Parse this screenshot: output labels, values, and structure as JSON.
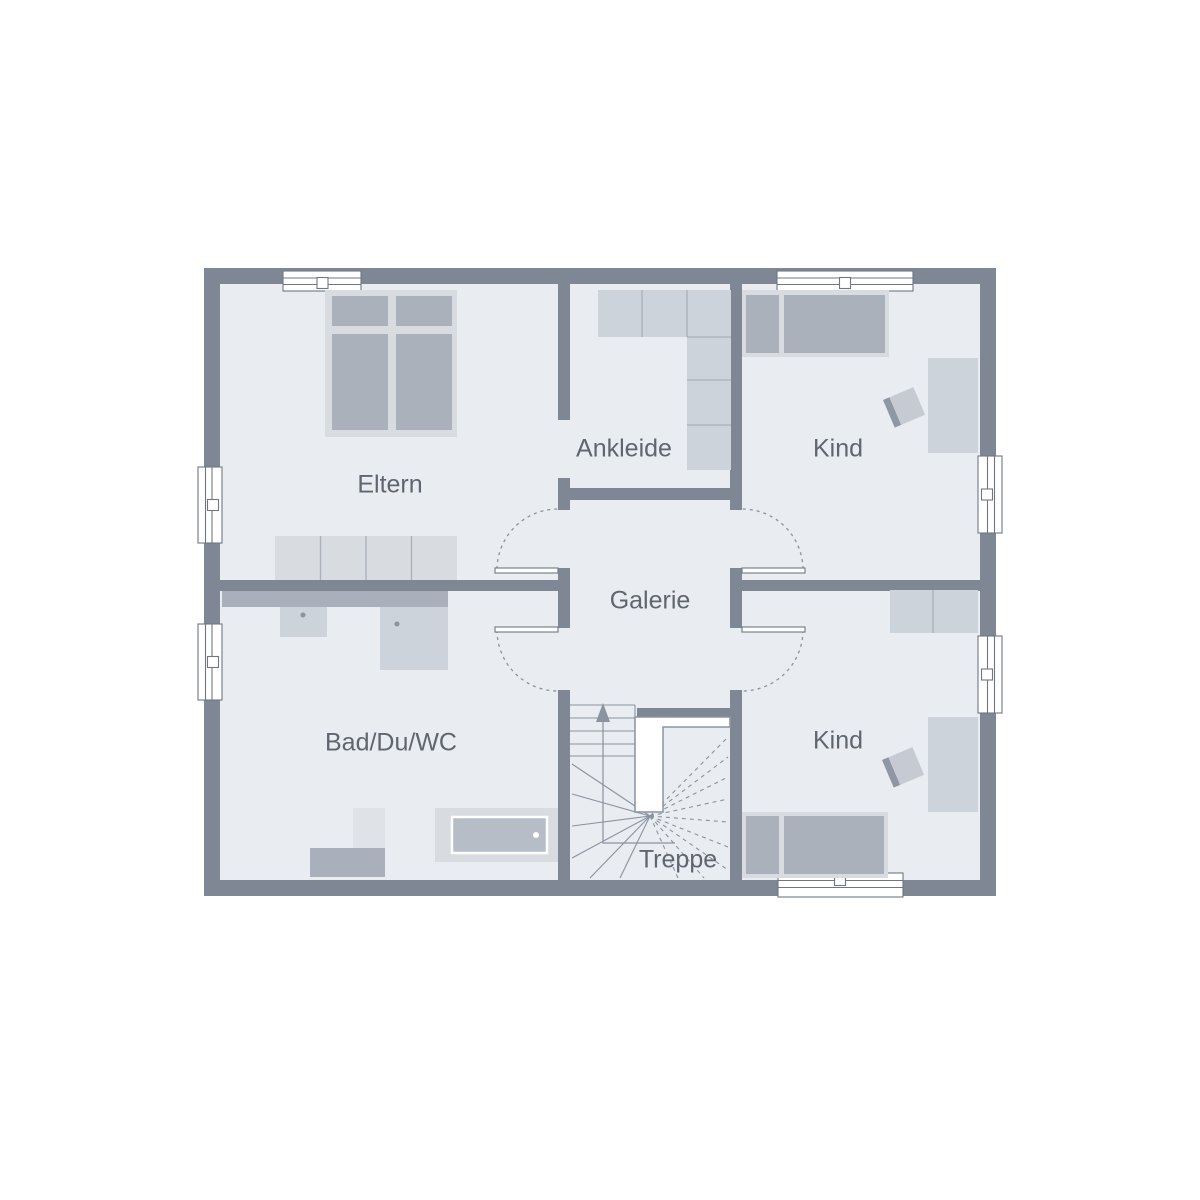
{
  "plan": {
    "type": "floor-plan",
    "rooms": [
      {
        "id": "eltern",
        "label": "Eltern"
      },
      {
        "id": "ankleide",
        "label": "Ankleide"
      },
      {
        "id": "kind-top",
        "label": "Kind"
      },
      {
        "id": "galerie",
        "label": "Galerie"
      },
      {
        "id": "bad",
        "label": "Bad/Du/WC"
      },
      {
        "id": "kind-bottom",
        "label": "Kind"
      },
      {
        "id": "treppe",
        "label": "Treppe"
      }
    ]
  },
  "colors": {
    "wall": "#7E8793",
    "floor": "#E9ECF0",
    "furn-light": "#CDD3DA",
    "furn-frame": "#D8DCE1",
    "furn-med": "#ABB1BB",
    "counter": "#A9B0BB",
    "pale": "#DFE3E8",
    "tub": "#B6BDC7",
    "divider": "#A9B0BA",
    "line": "#8A93A0",
    "winline": "#6E7884",
    "text": "#5E6670",
    "chair-seat": "#C6CBD3",
    "chair-back": "#8E97A3"
  }
}
